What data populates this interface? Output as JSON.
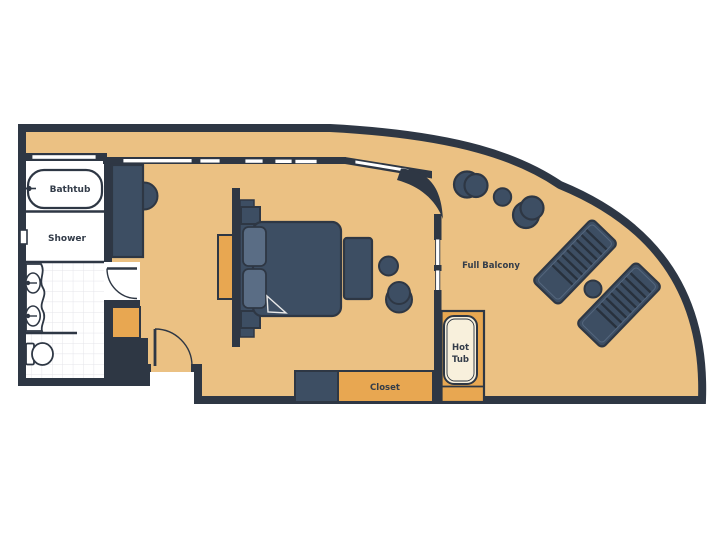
{
  "diagram": {
    "type": "cruise-suite-floor-plan",
    "labels": {
      "bathtub": "Bathtub",
      "shower": "Shower",
      "full_balcony": "Full Balcony",
      "hot_tub_line1": "Hot",
      "hot_tub_line2": "Tub",
      "closet": "Closet"
    },
    "fixtures": [
      "bathtub",
      "shower",
      "vanity-sinks",
      "toilet",
      "bathroom-door",
      "wardrobe",
      "entry-door",
      "desk",
      "headboard",
      "double-bed",
      "pillows",
      "nightstands",
      "bench",
      "stool",
      "round-chair",
      "balcony-sliding-door",
      "balcony-windows",
      "balcony-chairs",
      "side-tables",
      "sun-loungers",
      "closet-unit",
      "hot-tub",
      "hot-tub-platform"
    ],
    "colors": {
      "wall": "#2e3744",
      "floor": "#ebc183",
      "furniture": "#3d4e63",
      "furniture_light": "#5a6d85",
      "accent_orange": "#e8a751",
      "hot_tub_cream": "#f8f0dc",
      "background": "#ffffff",
      "tile_line": "#e4e4ea"
    }
  }
}
